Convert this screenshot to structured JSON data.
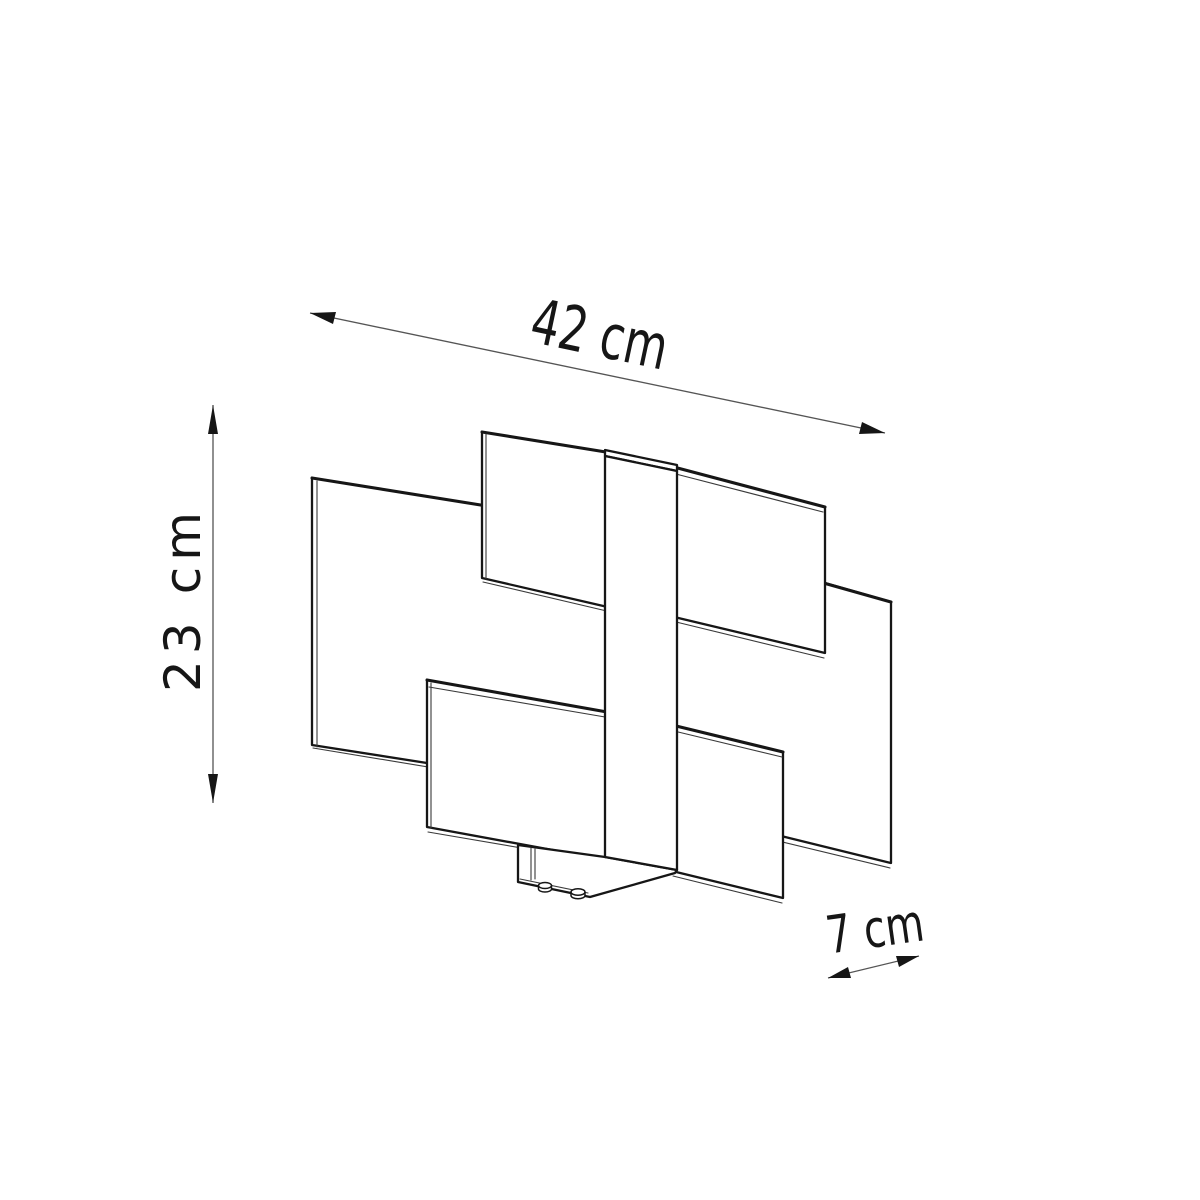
{
  "page": {
    "background_color": "#ffffff",
    "line_color": "#161616",
    "dimension_line_color": "#555555"
  },
  "dimensions": {
    "width": {
      "label": "42 cm"
    },
    "height": {
      "label": "23 cm"
    },
    "depth": {
      "label": "7 cm"
    }
  }
}
